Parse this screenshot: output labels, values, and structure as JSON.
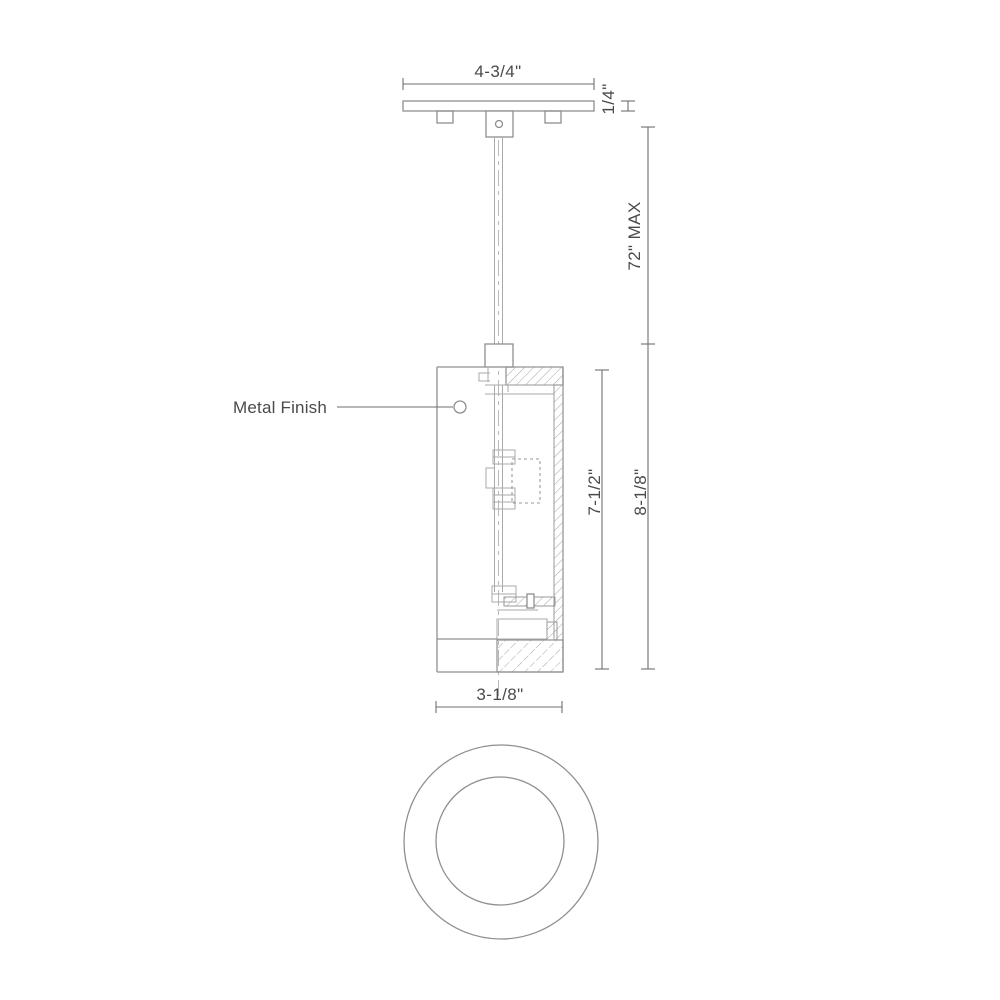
{
  "diagram": {
    "type": "technical-line-drawing",
    "subject": "pendant-light-fixture-dimension-spec",
    "labels": {
      "canopy_width": "4-3/4\"",
      "canopy_thickness": "1/4\"",
      "suspension_length": "72\" MAX",
      "body_inner_height": "7-1/2\"",
      "body_total_height": "8-1/8\"",
      "body_width": "3-1/8\"",
      "finish_callout": "Metal Finish"
    },
    "colors": {
      "background": "#ffffff",
      "outline": "#8f8f8f",
      "light_line": "#aaaaaa",
      "hatch": "#a5a5a5",
      "dimension_line": "#6f6f6f",
      "text": "#4a4a4a"
    }
  }
}
